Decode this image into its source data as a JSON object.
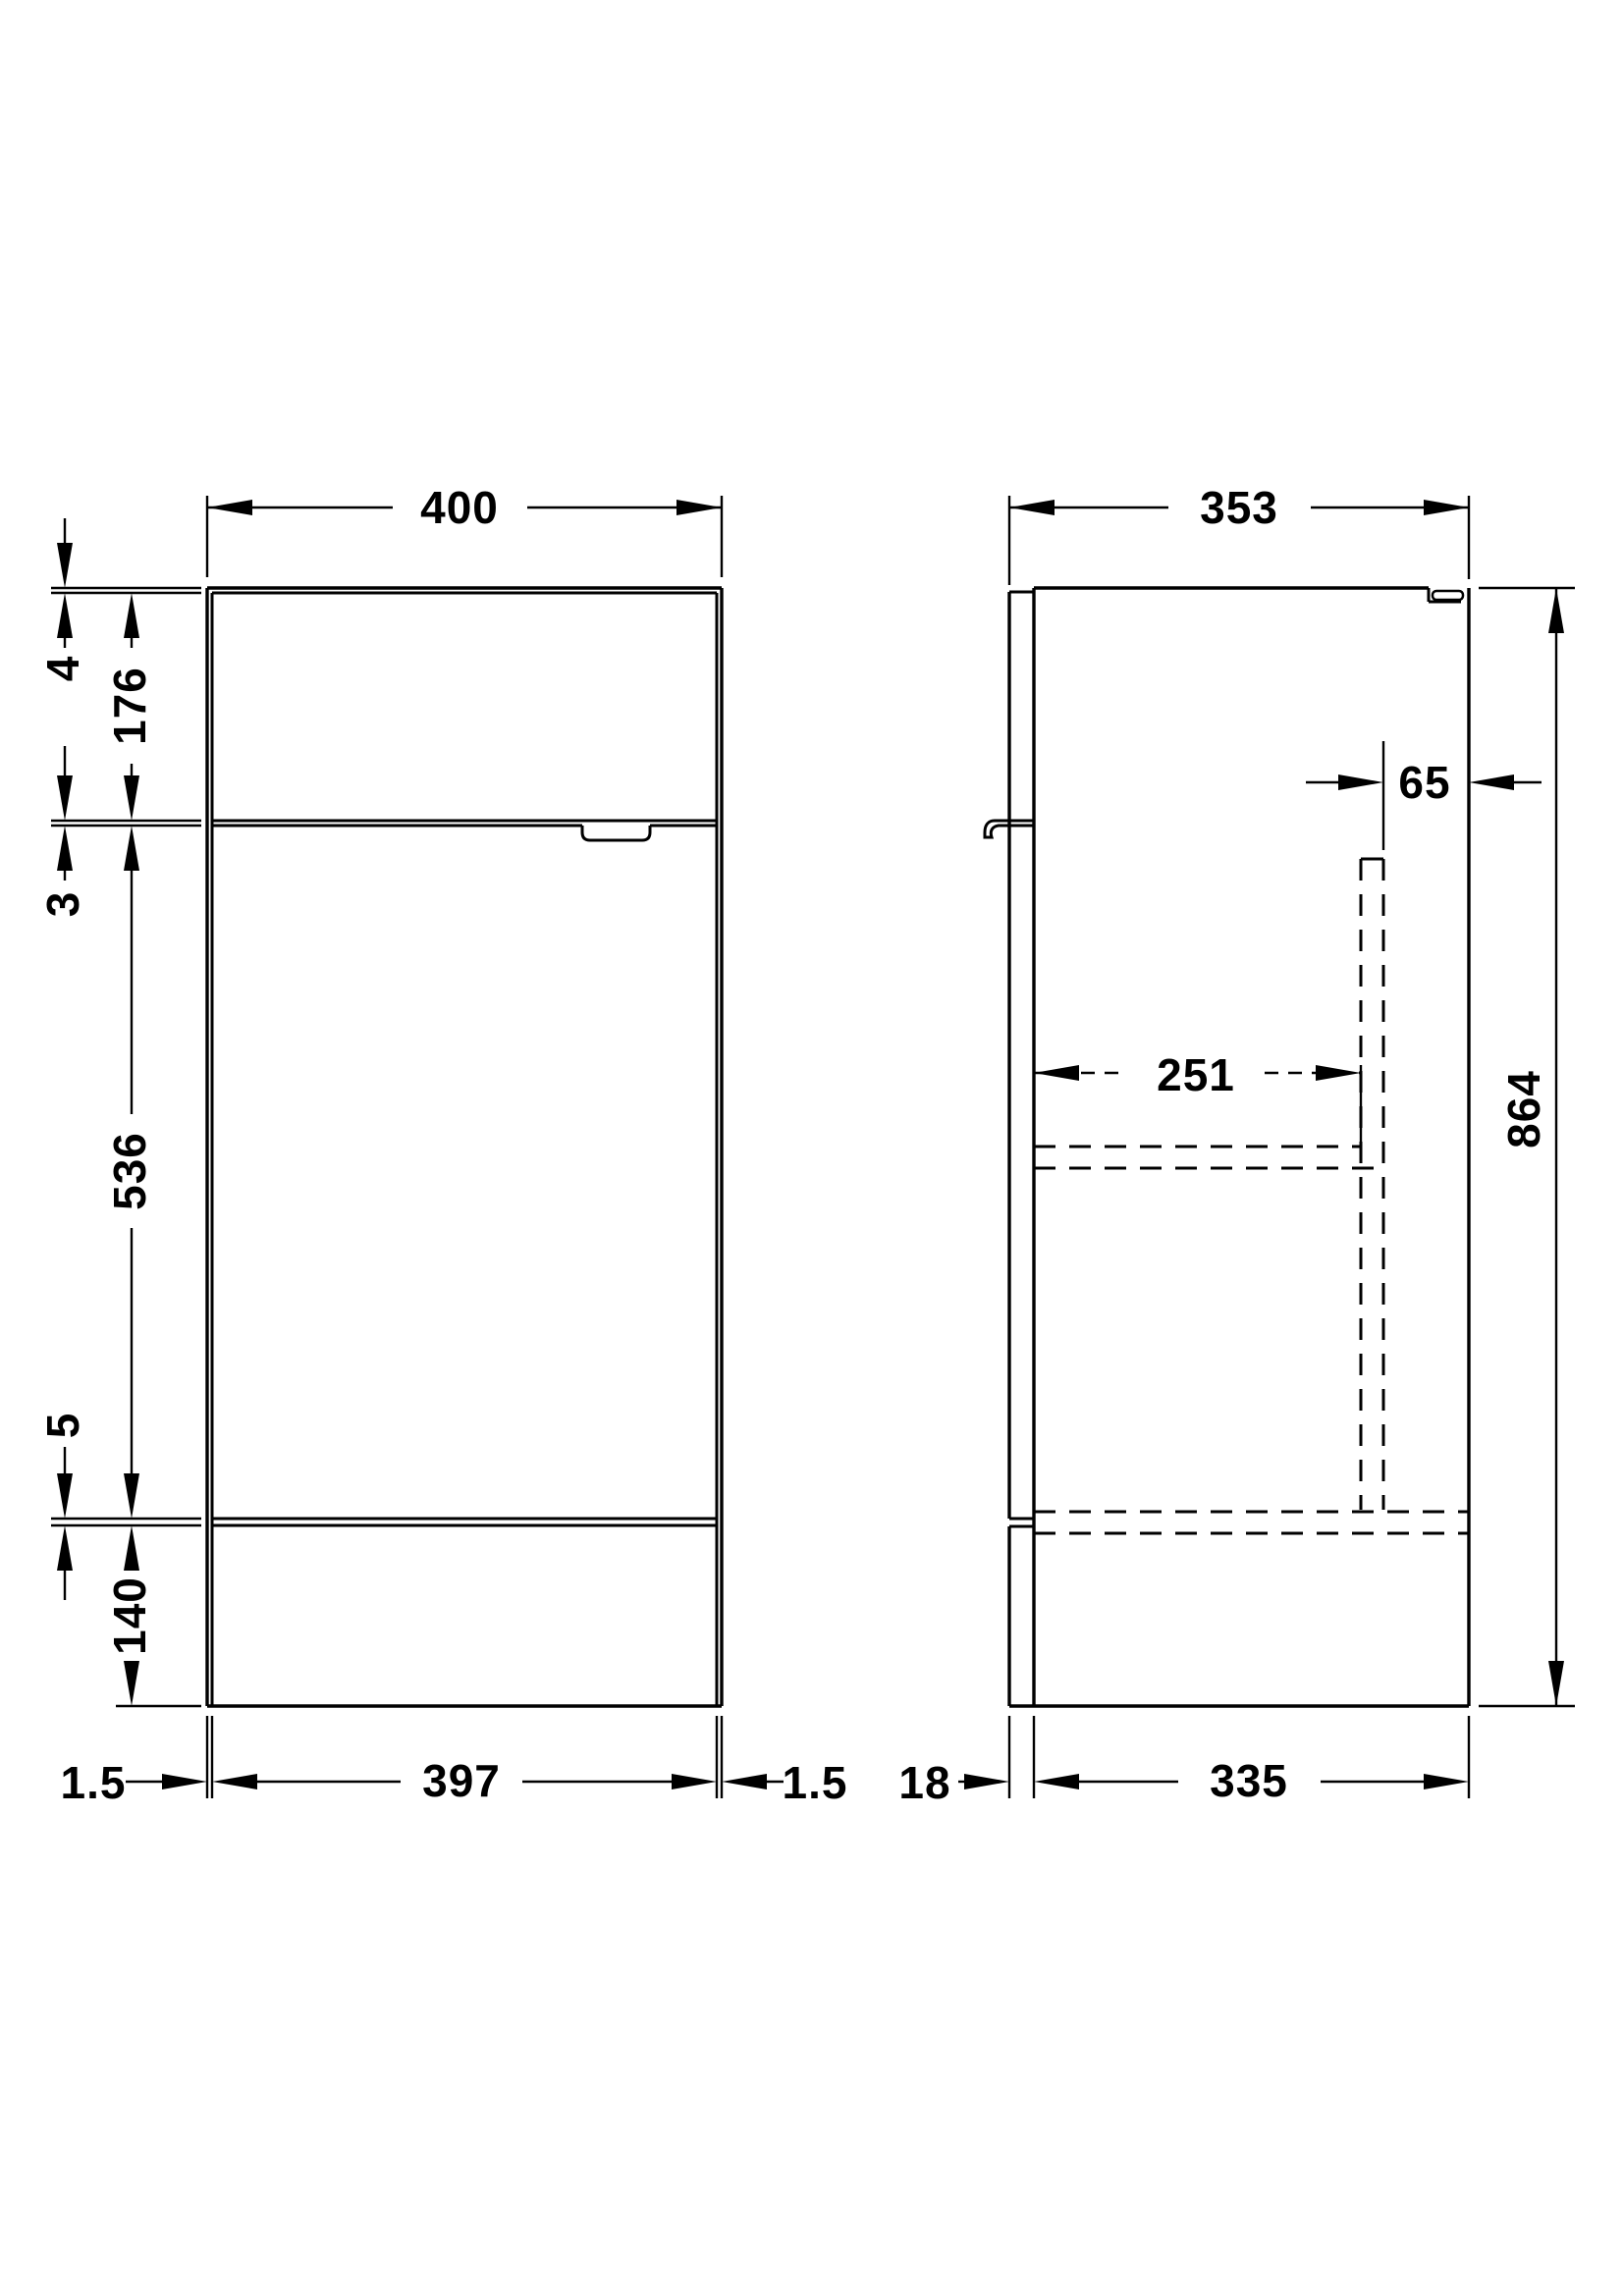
{
  "dimensions": {
    "front_view": {
      "overall_width": "400",
      "top_panel_thickness": "4",
      "upper_front_height": "176",
      "upper_gap": "3",
      "door_height": "536",
      "lower_gap": "5",
      "plinth_height": "140",
      "left_reveal": "1.5",
      "door_width": "397",
      "right_reveal": "1.5"
    },
    "side_view": {
      "overall_depth": "353",
      "pipe_offset_from_back": "65",
      "shelf_depth": "251",
      "overall_height": "864",
      "door_thickness": "18",
      "carcass_depth": "335"
    }
  },
  "colors": {
    "line": "#000000",
    "text": "#000000",
    "background": "#ffffff"
  }
}
